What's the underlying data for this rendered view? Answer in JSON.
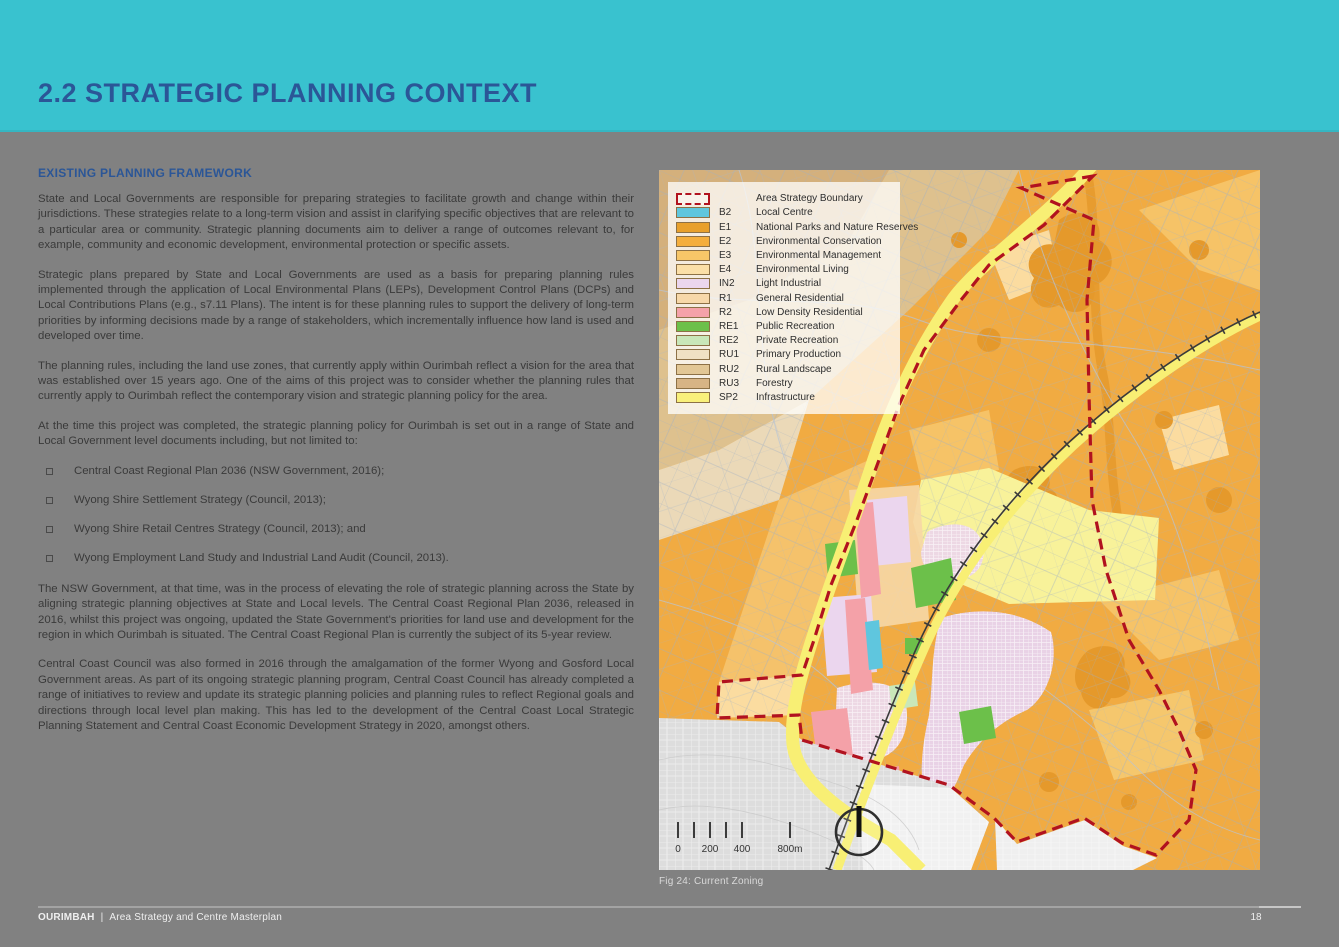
{
  "theme": {
    "accent_teal": "#39C2CF",
    "heading_blue": "#2B5697",
    "page_gray": "#818181",
    "boundary_red": "#B1121F"
  },
  "header": {
    "title": "2.2 STRATEGIC PLANNING CONTEXT"
  },
  "article": {
    "heading": "EXISTING PLANNING FRAMEWORK",
    "paragraphs": [
      "State and Local Governments are responsible for preparing strategies to facilitate growth and change within their jurisdictions. These strategies relate to a long-term vision and assist in clarifying specific objectives that are relevant to a particular area or community. Strategic planning documents aim to deliver a range of outcomes relevant to, for example, community and economic development, environmental protection or specific assets.",
      "Strategic plans prepared by State and Local Governments are used as a basis for preparing planning rules implemented through the application of Local Environmental Plans (LEPs), Development Control Plans (DCPs) and Local Contributions Plans (e.g., s7.11 Plans). The intent is for these planning rules to support the delivery of long-term priorities by informing decisions made by a range of stakeholders, which incrementally influence how land is used and developed over time.",
      "The planning rules, including the land use zones, that currently apply within Ourimbah reflect a vision for the area that was established over 15 years ago. One of the aims of this project was to consider whether the planning rules that currently apply to Ourimbah reflect the contemporary vision and strategic planning policy for the area.",
      "At the time this project was completed, the strategic planning policy for Ourimbah is set out in a range of State and Local Government level documents including, but not limited to:"
    ],
    "bullets": [
      "Central Coast Regional Plan 2036 (NSW Government, 2016);",
      "Wyong Shire Settlement Strategy (Council, 2013);",
      "Wyong Shire Retail Centres Strategy (Council, 2013); and",
      "Wyong Employment Land Study and Industrial Land Audit (Council, 2013)."
    ],
    "paragraphs2": [
      "The NSW Government, at that time, was in the process of elevating the role of strategic planning across the State by aligning strategic planning objectives at State and Local levels. The Central Coast Regional Plan 2036, released in 2016, whilst this project was ongoing, updated the State Government's priorities for land use and development for the region in which Ourimbah is situated. The Central Coast Regional Plan is currently the subject of its 5-year review.",
      "Central Coast Council was also formed in 2016 through the amalgamation of the former Wyong and Gosford Local Government areas. As part of its ongoing strategic planning program, Central Coast Council has already completed a range of initiatives to review and update its strategic planning policies and planning rules to reflect Regional goals and directions through local level plan making. This has led to the development of the Central Coast Local Strategic Planning Statement and Central Coast Economic Development Strategy in 2020, amongst others."
    ]
  },
  "map": {
    "caption": "Fig 24: Current Zoning",
    "legend": {
      "boundary": {
        "label": "Area Strategy Boundary",
        "color": "#B1121F"
      },
      "items": [
        {
          "code": "B2",
          "label": "Local Centre",
          "color": "#5FC6DE"
        },
        {
          "code": "E1",
          "label": "National Parks and Nature Reserves",
          "color": "#E8A02C"
        },
        {
          "code": "E2",
          "label": "Environmental Conservation",
          "color": "#F4AE3D"
        },
        {
          "code": "E3",
          "label": "Environmental Management",
          "color": "#F7C668"
        },
        {
          "code": "E4",
          "label": "Environmental Living",
          "color": "#FBDFA7"
        },
        {
          "code": "IN2",
          "label": "Light Industrial",
          "color": "#EBD6EE"
        },
        {
          "code": "R1",
          "label": "General Residential",
          "color": "#F7D8A9"
        },
        {
          "code": "R2",
          "label": "Low Density Residential",
          "color": "#F5A2A9"
        },
        {
          "code": "RE1",
          "label": "Public Recreation",
          "color": "#6CC04A"
        },
        {
          "code": "RE2",
          "label": "Private Recreation",
          "color": "#C9E7B9"
        },
        {
          "code": "RU1",
          "label": "Primary Production",
          "color": "#F0E1C4"
        },
        {
          "code": "RU2",
          "label": "Rural Landscape",
          "color": "#E2C795"
        },
        {
          "code": "RU3",
          "label": "Forestry",
          "color": "#D7B485"
        },
        {
          "code": "SP2",
          "label": "Infrastructure",
          "color": "#F9F07B"
        }
      ]
    },
    "scale_labels": [
      "0",
      "200",
      "400",
      "800m"
    ]
  },
  "footer": {
    "doc_title": "OURIMBAH",
    "separator": "|",
    "subtitle": "Area Strategy and Centre Masterplan",
    "page_number": "18"
  }
}
